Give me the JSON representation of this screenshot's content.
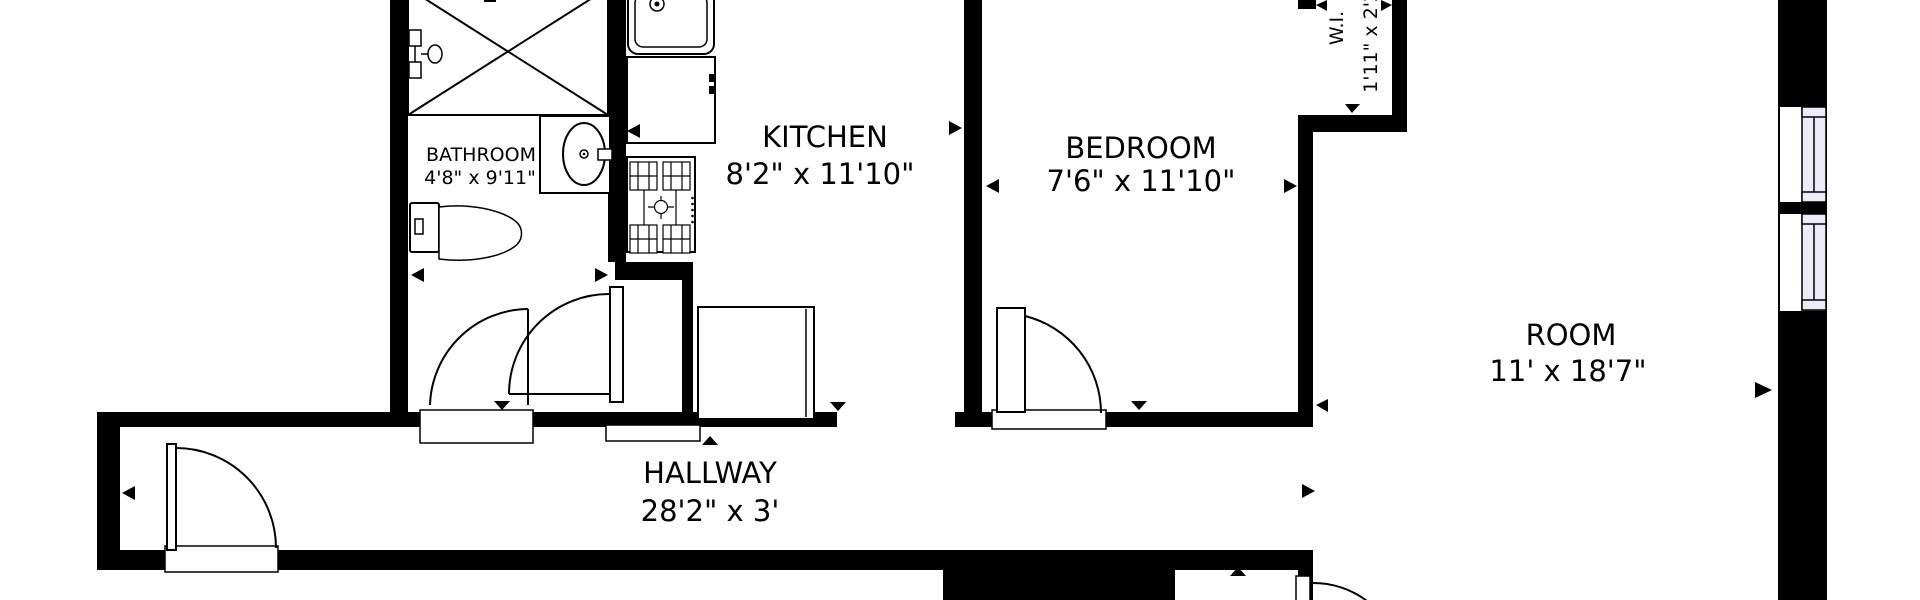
{
  "colors": {
    "wall": "#000000",
    "background": "#ffffff",
    "window_fill": "#ecebf7"
  },
  "rooms": {
    "bathroom": {
      "label": "BATHROOM",
      "dimensions": "4'8\" x 9'11\""
    },
    "kitchen": {
      "label": "KITCHEN",
      "dimensions": "8'2\" x 11'10\""
    },
    "bedroom": {
      "label": "BEDROOM",
      "dimensions": "7'6\" x 11'10\""
    },
    "walk_in_closet": {
      "label": "W.I.",
      "dimensions": "1'11\" x 2'2\""
    },
    "room": {
      "label": "ROOM",
      "dimensions": "11' x 18'7\""
    },
    "hallway": {
      "label": "HALLWAY",
      "dimensions": "28'2\" x 3'"
    }
  }
}
